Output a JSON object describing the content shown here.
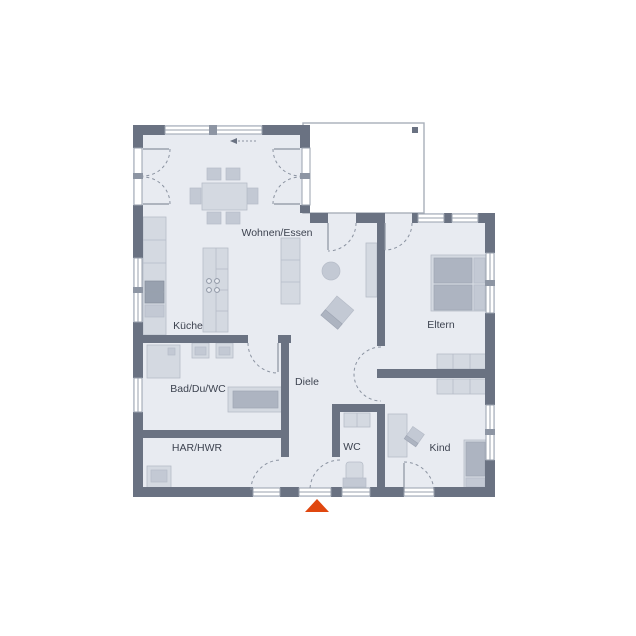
{
  "page": {
    "title": "Bungalow Grundriss"
  },
  "labels": {
    "living": "Wohnen/Essen",
    "kitchen": "Küche",
    "parents": "Eltern",
    "bath": "Bad/Du/WC",
    "hall": "Diele",
    "utility": "HAR/HWR",
    "wc": "WC",
    "child": "Kind"
  },
  "icons": {
    "entrance_marker": "triangle-up",
    "sliding_direction": "arrow-left-dashed"
  },
  "colors": {
    "wall": "#6a7282",
    "floor": "#e8ebf1",
    "furniture": "#d4d9e1",
    "furniture_mid": "#c3c9d4",
    "furniture_dark": "#adb4c1",
    "furniture_stroke": "#b6bcc8",
    "appliance": "#98a1af",
    "outline": "#99a1ae",
    "arc": "#8b93a1",
    "text": "#3d4350",
    "accent": "#e0470f",
    "terrace_border": "#a9afba",
    "post": "#8d95a3",
    "white": "#ffffff"
  }
}
